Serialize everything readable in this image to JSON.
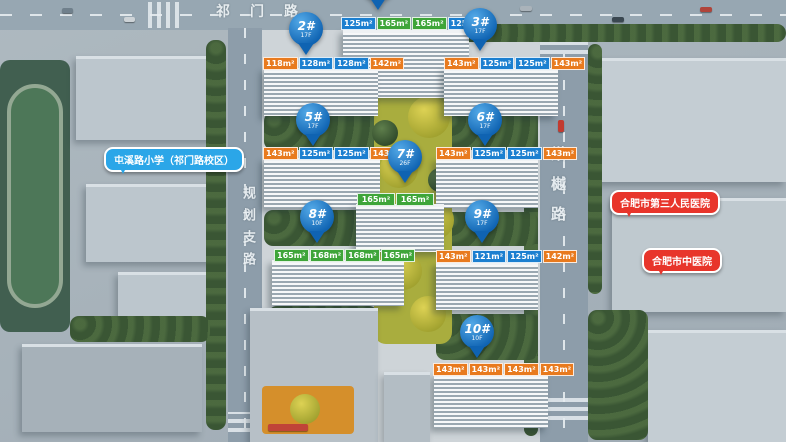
{
  "map": {
    "roads": {
      "top": "祁门路",
      "left": "规划支路",
      "right": "棠樾路"
    },
    "landmarks": {
      "school": "屯溪路小学（祁门路校区）",
      "hospital_1": "合肥市第三人民医院",
      "hospital_2": "合肥市中医院"
    },
    "buildings": [
      {
        "pin": "",
        "floors": "",
        "units": [
          {
            "area": "125m²"
          },
          {
            "area": "165m²"
          },
          {
            "area": "165m²"
          },
          {
            "area": "125m²"
          }
        ]
      },
      {
        "pin": "2#",
        "floors": "17F",
        "units": [
          {
            "area": "118m²"
          },
          {
            "area": "128m²"
          },
          {
            "area": "128m²"
          },
          {
            "area": "142m²"
          }
        ]
      },
      {
        "pin": "3#",
        "floors": "17F",
        "units": [
          {
            "area": "143m²"
          },
          {
            "area": "125m²"
          },
          {
            "area": "125m²"
          },
          {
            "area": "143m²"
          }
        ]
      },
      {
        "pin": "5#",
        "floors": "17F",
        "units": [
          {
            "area": "143m²"
          },
          {
            "area": "125m²"
          },
          {
            "area": "125m²"
          },
          {
            "area": "143m²"
          }
        ]
      },
      {
        "pin": "6#",
        "floors": "17F",
        "units": [
          {
            "area": "143m²"
          },
          {
            "area": "125m²"
          },
          {
            "area": "125m²"
          },
          {
            "area": "143m²"
          }
        ]
      },
      {
        "pin": "7#",
        "floors": "26F",
        "units": [
          {
            "area": "165m²"
          },
          {
            "area": "165m²"
          }
        ]
      },
      {
        "pin": "8#",
        "floors": "10F",
        "units": [
          {
            "area": "165m²"
          },
          {
            "area": "168m²"
          },
          {
            "area": "168m²"
          },
          {
            "area": "165m²"
          }
        ]
      },
      {
        "pin": "9#",
        "floors": "17F",
        "units": [
          {
            "area": "143m²"
          },
          {
            "area": "121m²"
          },
          {
            "area": "125m²"
          },
          {
            "area": "142m²"
          }
        ]
      },
      {
        "pin": "10#",
        "floors": "10F",
        "units": [
          {
            "area": "143m²"
          },
          {
            "area": "143m²"
          },
          {
            "area": "143m²"
          },
          {
            "area": "143m²"
          }
        ]
      }
    ],
    "colors": {
      "pin_blue": "#1574c4",
      "unit_blue": "#1b7fd0",
      "unit_orange": "#e87a1e",
      "unit_green": "#3ea539",
      "bubble_red": "#e8352b",
      "bubble_blue": "#2ba6e8"
    }
  }
}
